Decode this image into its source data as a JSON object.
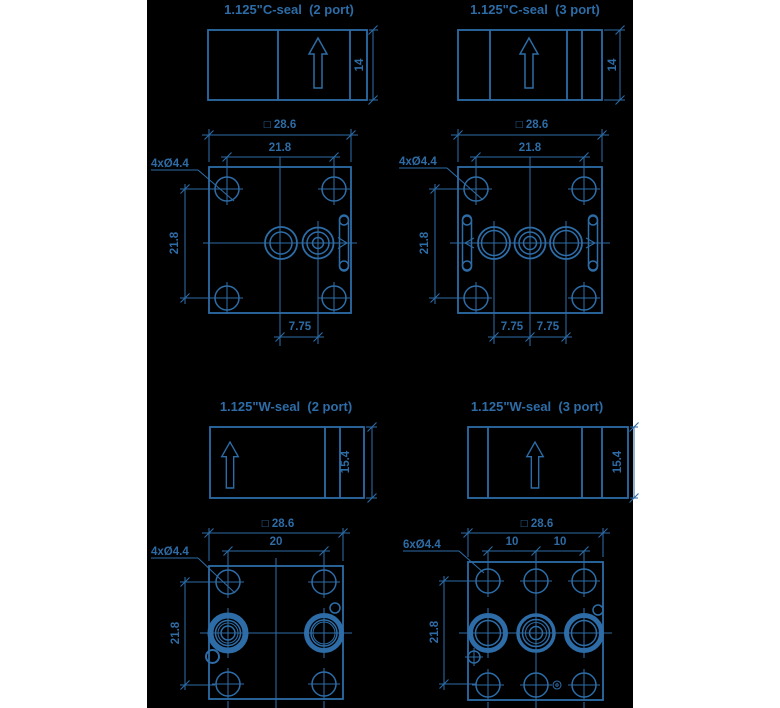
{
  "page": {
    "background_color": "#ffffff",
    "panel_background_color": "#000000",
    "line_color": "#2d6ca6"
  },
  "views": {
    "c2": {
      "title": "1.125\"C-seal  (2 port)",
      "thickness": "14",
      "outline_square": "□ 28.6",
      "hole_pitch_h": "21.8",
      "hole_pitch_v": "21.8",
      "holes_label": "4xØ4.4",
      "port_pitch": "7.75"
    },
    "c3": {
      "title": "1.125\"C-seal  (3 port)",
      "thickness": "14",
      "outline_square": "□ 28.6",
      "hole_pitch_h": "21.8",
      "hole_pitch_v": "21.8",
      "holes_label": "4xØ4.4",
      "port_pitch_left": "7.75",
      "port_pitch_right": "7.75"
    },
    "w2": {
      "title": "1.125\"W-seal  (2 port)",
      "thickness": "15.4",
      "outline_square": "□ 28.6",
      "hole_pitch_h": "20",
      "hole_pitch_v": "21.8",
      "holes_label": "4xØ4.4"
    },
    "w3": {
      "title": "1.125\"W-seal  (3 port)",
      "thickness": "15.4",
      "outline_square": "□ 28.6",
      "hole_pitch_left": "10",
      "hole_pitch_right": "10",
      "hole_pitch_v": "21.8",
      "holes_label": "6xØ4.4"
    }
  }
}
